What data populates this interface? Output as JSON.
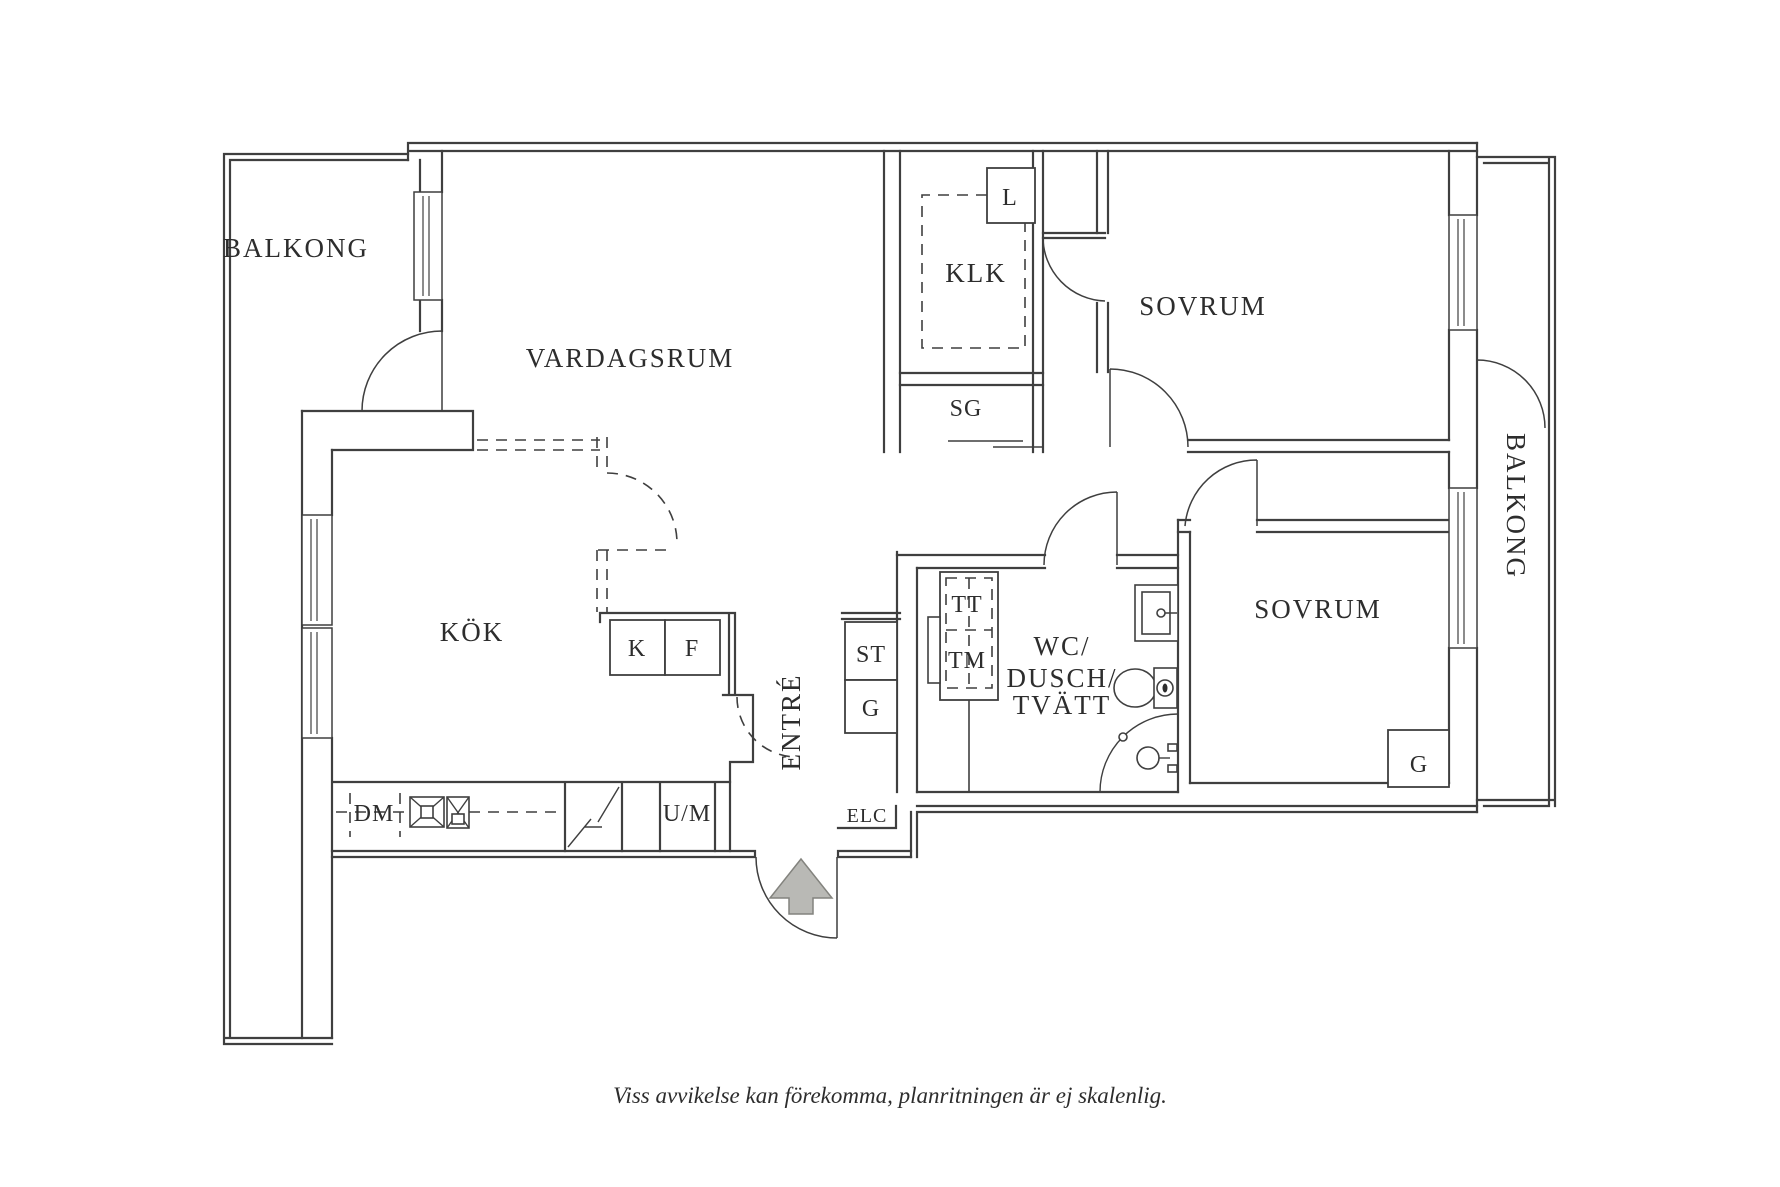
{
  "plan": {
    "rooms": {
      "balcony_left": "BALKONG",
      "living_room": "VARDAGSRUM",
      "walk_in_closet": "KLK",
      "bedroom_top": "SOVRUM",
      "sliding_closet": "SG",
      "kitchen": "KÖK",
      "entry": "ENTRÉ",
      "bathroom_line1": "WC/",
      "bathroom_line2": "DUSCH/",
      "bathroom_line3": "TVÄTT",
      "bedroom_bottom": "SOVRUM",
      "balcony_right": "BALKONG"
    },
    "appliances": {
      "linen_closet": "L",
      "fridge": "K",
      "freezer": "F",
      "dishwasher": "DM",
      "oven_microwave": "U/M",
      "cleaning_closet": "ST",
      "hall_wardrobe": "G",
      "tumble_dryer": "TT",
      "washing_machine": "TM",
      "electrical_cabinet": "ELC",
      "bedroom_wardrobe": "G"
    },
    "footer": "Viss avvikelse kan förekomma, planritningen är ej skalenlig.",
    "colors": {
      "wall": "#3f3f3f",
      "text": "#2d2d2d",
      "arrow_fill": "#b9b9b5",
      "arrow_stroke": "#83837e"
    }
  }
}
